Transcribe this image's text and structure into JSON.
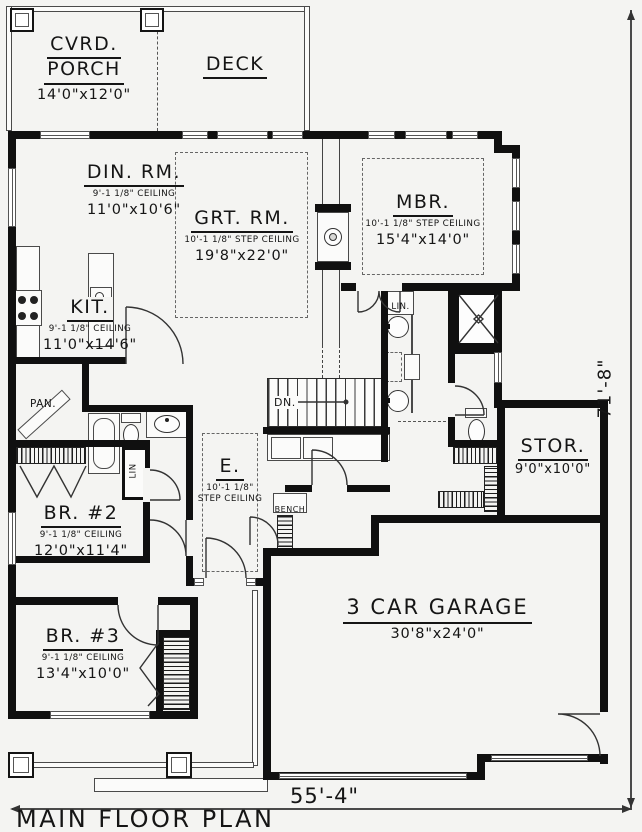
{
  "title": "MAIN FLOOR PLAN",
  "dims": {
    "width_label": "55'-4\"",
    "height_label": "71'-8\""
  },
  "rooms": {
    "porch": {
      "line1": "CVRD.",
      "line2": "PORCH",
      "size": "14'0\"x12'0\""
    },
    "deck": {
      "name": "DECK"
    },
    "din": {
      "name": "DIN. RM.",
      "ceiling": "9'-1 1/8\" CEILING",
      "size": "11'0\"x10'6\""
    },
    "grt": {
      "name": "GRT. RM.",
      "ceiling": "10'-1 1/8\" STEP CEILING",
      "size": "19'8\"x22'0\""
    },
    "mbr": {
      "name": "MBR.",
      "ceiling": "10'-1 1/8\" STEP CEILING",
      "size": "15'4\"x14'0\""
    },
    "kit": {
      "name": "KIT.",
      "ceiling": "9'-1 1/8\" CEILING",
      "size": "11'0\"x14'6\""
    },
    "br2": {
      "name": "BR. #2",
      "ceiling": "9'-1 1/8\" CEILING",
      "size": "12'0\"x11'4\""
    },
    "br3": {
      "name": "BR. #3",
      "ceiling": "9'-1 1/8\" CEILING",
      "size": "13'4\"x10'0\""
    },
    "entry": {
      "name": "E.",
      "ceiling1": "10'-1 1/8\"",
      "ceiling2": "STEP CEILING"
    },
    "stor": {
      "name": "STOR.",
      "size": "9'0\"x10'0\""
    },
    "garage": {
      "name": "3 CAR GARAGE",
      "size": "30'8\"x24'0\""
    }
  },
  "labels": {
    "pan": "PAN.",
    "lin_bath": "LIN.",
    "lin_hall": "LIN",
    "dn": "DN.",
    "bench": "BENCH"
  },
  "colors": {
    "ink": "#101010",
    "paper": "#f4f4f2"
  }
}
